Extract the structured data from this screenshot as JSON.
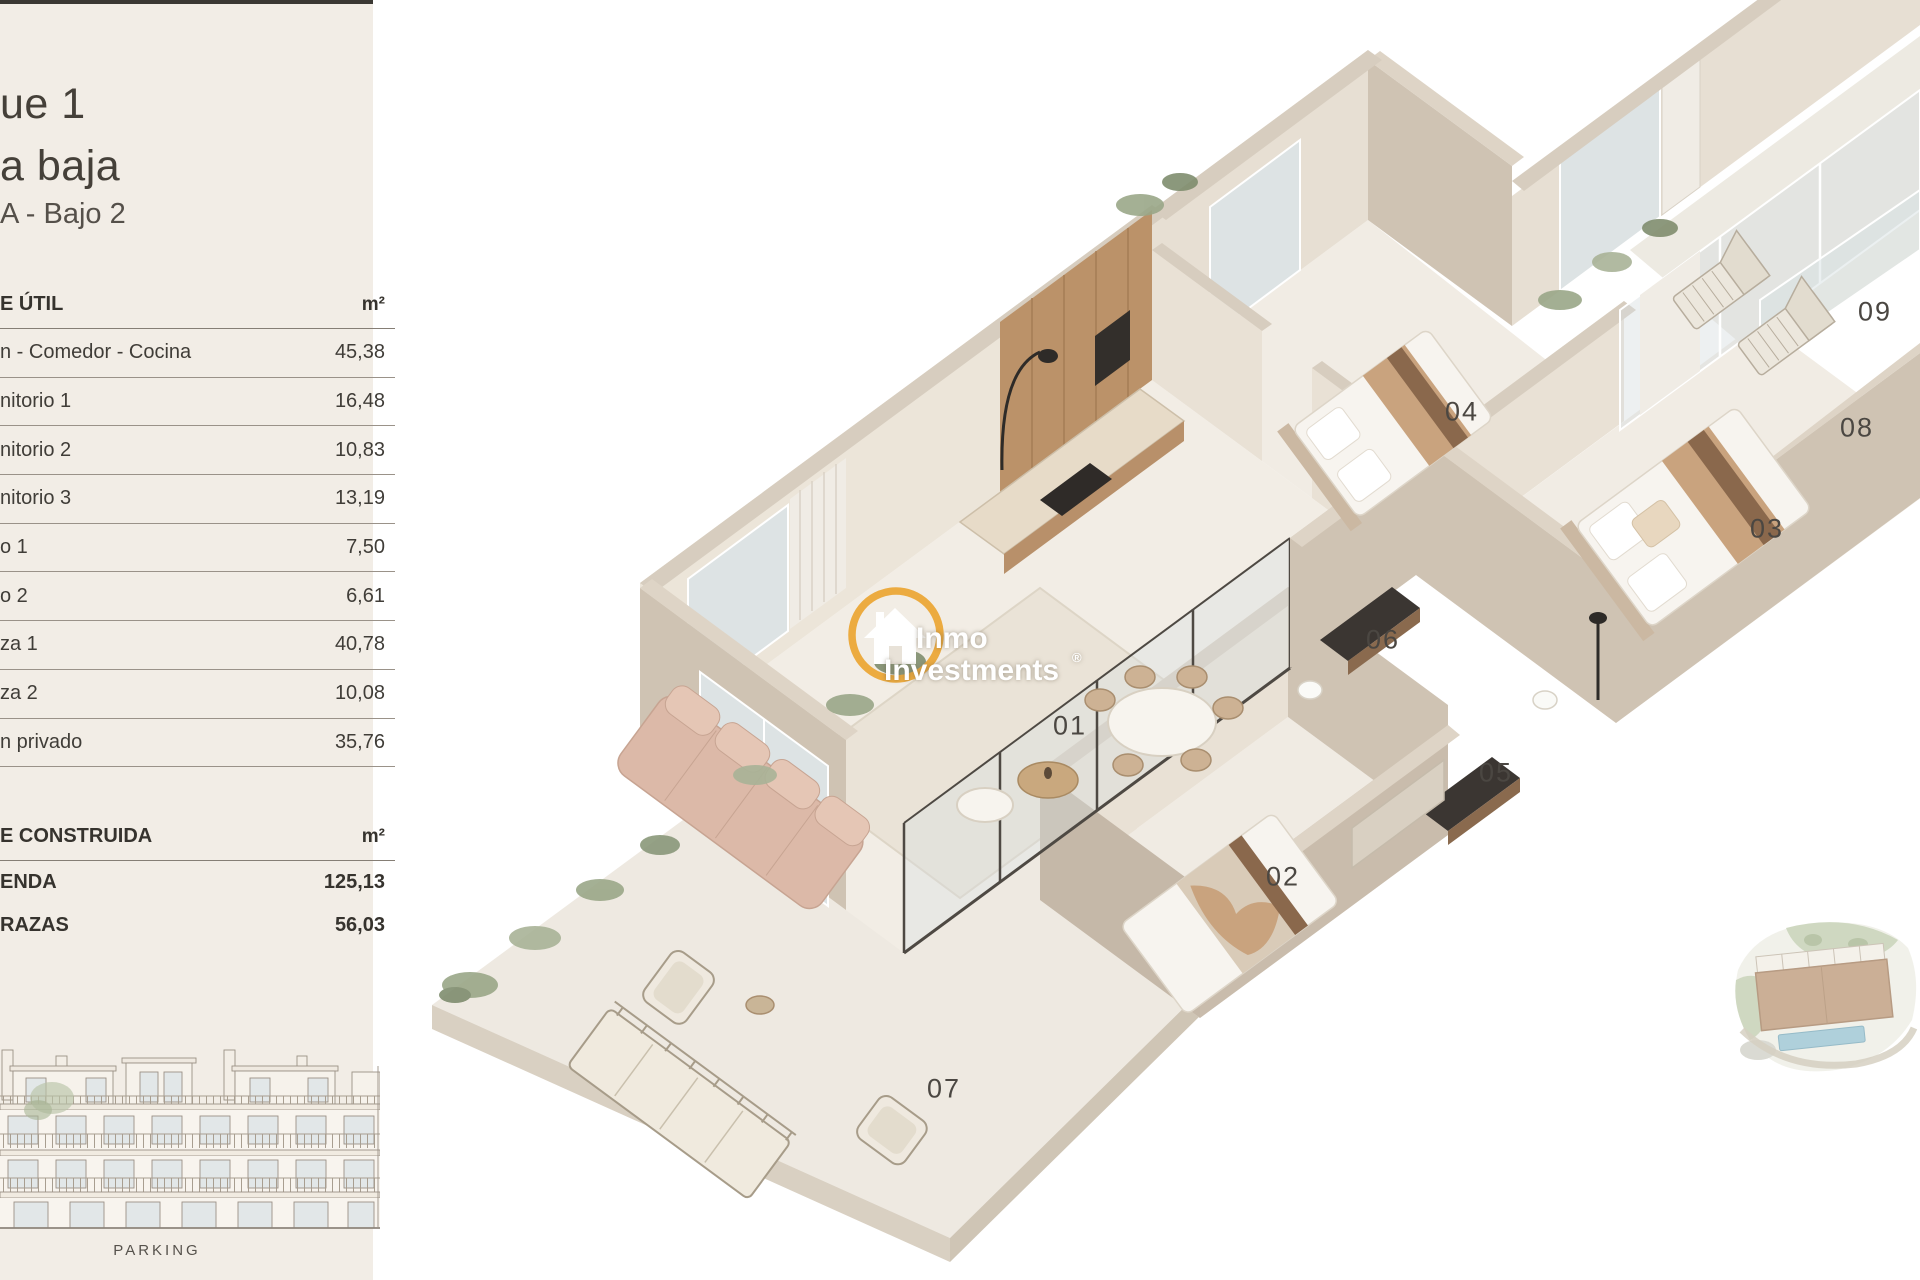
{
  "panel": {
    "title_line1": "ue 1",
    "title_line2": "a baja",
    "subtitle": "A - Bajo 2",
    "surface_util": {
      "header": "E ÚTIL",
      "unit": "m²",
      "rows": [
        {
          "label": "n - Comedor - Cocina",
          "value": "45,38"
        },
        {
          "label": "nitorio 1",
          "value": "16,48"
        },
        {
          "label": "nitorio 2",
          "value": "10,83"
        },
        {
          "label": "nitorio 3",
          "value": "13,19"
        },
        {
          "label": "o 1",
          "value": "7,50"
        },
        {
          "label": "o 2",
          "value": "6,61"
        },
        {
          "label": "za 1",
          "value": "40,78"
        },
        {
          "label": "za 2",
          "value": "10,08"
        },
        {
          "label": "n privado",
          "value": "35,76"
        }
      ]
    },
    "surface_construida": {
      "header": "E CONSTRUIDA",
      "unit": "m²",
      "rows": [
        {
          "label": "ENDA",
          "value": "125,13"
        },
        {
          "label": "RAZAS",
          "value": "56,03"
        }
      ]
    },
    "elevation_caption": "PARKING"
  },
  "floorplan": {
    "room_labels": [
      {
        "id": "01",
        "x": 1070,
        "y": 726
      },
      {
        "id": "02",
        "x": 1283,
        "y": 877
      },
      {
        "id": "03",
        "x": 1767,
        "y": 529
      },
      {
        "id": "04",
        "x": 1462,
        "y": 412
      },
      {
        "id": "05",
        "x": 1496,
        "y": 773
      },
      {
        "id": "06",
        "x": 1383,
        "y": 640
      },
      {
        "id": "07",
        "x": 944,
        "y": 1089
      },
      {
        "id": "08",
        "x": 1857,
        "y": 428
      },
      {
        "id": "09",
        "x": 1875,
        "y": 312
      }
    ]
  },
  "logo": {
    "line1": "Inmo",
    "line2": "Investments",
    "registered": "®",
    "gold": "#ecab40"
  },
  "colors": {
    "panel_bg": "#f2ede6",
    "top_line": "#3b3833",
    "wall_taupe": "#cfc3b3",
    "wall_cap": "#d7cdbf",
    "floor_cream": "#f2ede5",
    "wood": "#bb9269",
    "sofa_blush": "#dcb9a8",
    "glass": "#dde3e4",
    "greenery": "#9aa788",
    "pool_blue": "#a9cdd9"
  }
}
